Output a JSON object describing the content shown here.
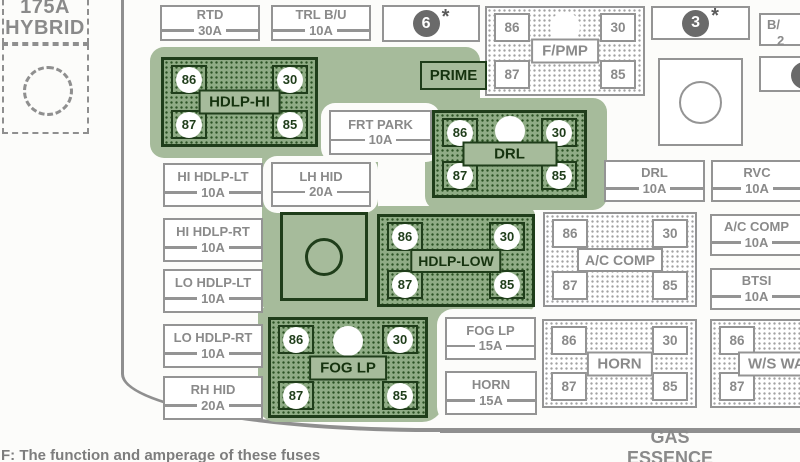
{
  "diagram": {
    "hybrid": {
      "amperage": "175A",
      "name": "HYBRID"
    },
    "markers": {
      "six": "6",
      "three": "3",
      "star": "*"
    },
    "prime_label": "PRIME",
    "partial_top_box": {
      "line1": "B/",
      "line2": "2"
    },
    "fuses": {
      "rtd": {
        "name": "RTD",
        "amp": "30A"
      },
      "trl_bu": {
        "name": "TRL B/U",
        "amp": "10A"
      },
      "frt_park": {
        "name": "FRT PARK",
        "amp": "10A"
      },
      "hi_hdlp_lt": {
        "name": "HI HDLP-LT",
        "amp": "10A"
      },
      "lh_hid": {
        "name": "LH HID",
        "amp": "20A"
      },
      "hi_hdlp_rt": {
        "name": "HI HDLP-RT",
        "amp": "10A"
      },
      "lo_hdlp_lt": {
        "name": "LO HDLP-LT",
        "amp": "10A"
      },
      "lo_hdlp_rt": {
        "name": "LO HDLP-RT",
        "amp": "10A"
      },
      "rh_hid": {
        "name": "RH HID",
        "amp": "20A"
      },
      "drl": {
        "name": "DRL",
        "amp": "10A"
      },
      "rvc": {
        "name": "RVC",
        "amp": "10A"
      },
      "ac_comp": {
        "name": "A/C COMP",
        "amp": "10A"
      },
      "btsi": {
        "name": "BTSI",
        "amp": "10A"
      },
      "fog_lp": {
        "name": "FOG LP",
        "amp": "15A"
      },
      "horn": {
        "name": "HORN",
        "amp": "15A"
      }
    },
    "relays": {
      "hdlp_hi": {
        "label": "HDLP-HI",
        "pins": {
          "tl": "86",
          "tr": "30",
          "bl": "87",
          "br": "85"
        }
      },
      "f_pmp": {
        "label": "F/PMP",
        "pins": {
          "tl": "86",
          "tr": "30",
          "bl": "87",
          "br": "85"
        }
      },
      "drl": {
        "label": "DRL",
        "pins": {
          "tl": "86",
          "tr": "30",
          "bl": "87",
          "br": "85"
        }
      },
      "hdlp_low": {
        "label": "HDLP-LOW",
        "pins": {
          "tl": "86",
          "tr": "30",
          "bl": "87",
          "br": "85"
        }
      },
      "ac_comp": {
        "label": "A/C COMP",
        "pins": {
          "tl": "86",
          "tr": "30",
          "bl": "87",
          "br": "85"
        }
      },
      "fog_lp": {
        "label": "FOG LP",
        "pins": {
          "tl": "86",
          "tr": "30",
          "bl": "87",
          "br": "85"
        }
      },
      "horn": {
        "label": "HORN",
        "pins": {
          "tl": "86",
          "tr": "30",
          "bl": "87",
          "br": "85"
        }
      },
      "ws_wa": {
        "label": "W/S WA",
        "pins": {
          "tl": "86",
          "bl": "87"
        }
      }
    },
    "footer": {
      "fuel_line1": "GAS",
      "fuel_line2": "ESSENCE",
      "footnote": "F: The function and amperage of these fuses"
    },
    "colors": {
      "highlight": "#a6bb9b",
      "relay_green": "#8fac85",
      "dark_green": "#1f3d1a",
      "gray": "#8a8a8a"
    }
  }
}
